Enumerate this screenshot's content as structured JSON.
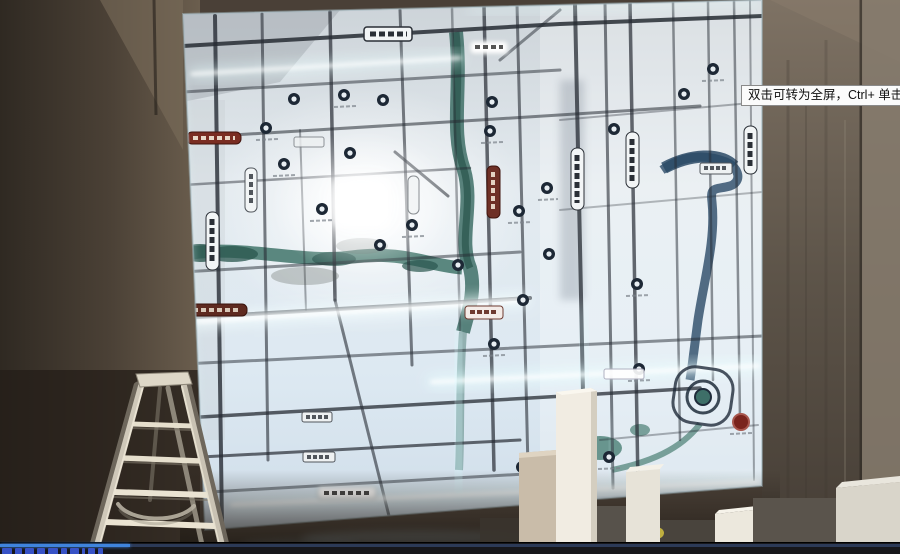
{
  "tooltip": {
    "text": "双击可转为全屏，Ctrl+ 单击可转为"
  },
  "player": {
    "progress_percent": 14.4
  },
  "colors": {
    "progress-fill": "#3f84dd",
    "progress-track": "#2c3a57",
    "bar-bg": "#17171b",
    "tooltip-bg": "#fbfbfb",
    "tooltip-border": "#8a8a8a",
    "tooltip-text": "#111111",
    "map-glow": "#eaffff",
    "river-teal": "#3e6f66",
    "river-navy": "#2b4a66"
  }
}
